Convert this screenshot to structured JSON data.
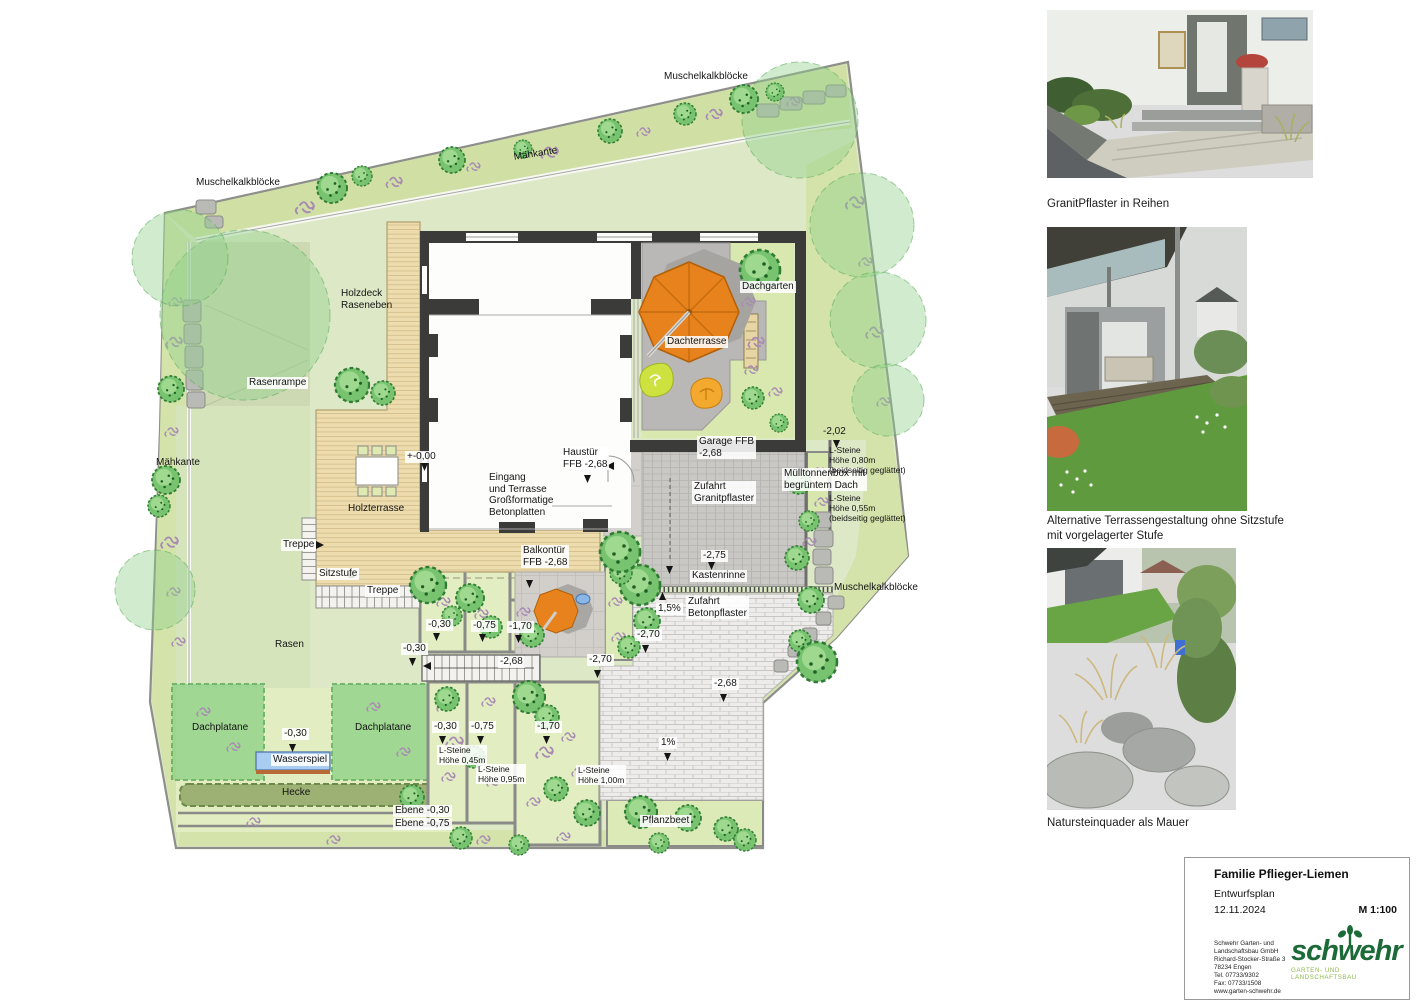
{
  "plan": {
    "labels": [
      {
        "t": "Muschelkalkblöcke"
      },
      {
        "t": "Mähkante"
      },
      {
        "t": "Muschelkalkblöcke"
      },
      {
        "t": "Holzdeck\nRaseneben"
      },
      {
        "t": "Rasenrampe"
      },
      {
        "t": "Mähkante"
      },
      {
        "t": "+-0,00"
      },
      {
        "t": "Holzterrasse"
      },
      {
        "t": "Haustür\nFFB  -2,68"
      },
      {
        "t": "Eingang\nund Terrasse\nGroßformatige\nBetonplatten"
      },
      {
        "t": "Garage FFB\n-2,68"
      },
      {
        "t": "Dachterrasse"
      },
      {
        "t": "Dachgarten"
      },
      {
        "t": "Zufahrt\nGranitpflaster"
      },
      {
        "t": "Mülltonnenbox mit\nbegrüntem Dach"
      },
      {
        "t": "-2,02"
      },
      {
        "t": "L-Steine\nHöhe 0,80m\n(beidseitig geglättet)"
      },
      {
        "t": "L-Steine\nHöhe 0,55m\n(beidseitig geglättet)"
      },
      {
        "t": "Muschelkalkblöcke"
      },
      {
        "t": "Treppe"
      },
      {
        "t": "Sitzstufe"
      },
      {
        "t": "Treppe"
      },
      {
        "t": "Balkontür\nFFB -2,68"
      },
      {
        "t": "-2,75"
      },
      {
        "t": "Kastenrinne"
      },
      {
        "t": "1,5%"
      },
      {
        "t": "Zufahrt\nBetonpflaster"
      },
      {
        "t": "-2,70"
      },
      {
        "t": "-2,70"
      },
      {
        "t": "-2,68"
      },
      {
        "t": "-2,68"
      },
      {
        "t": "1%"
      },
      {
        "t": "-0,30"
      },
      {
        "t": "-0,75"
      },
      {
        "t": "-1,70"
      },
      {
        "t": "-0,30"
      },
      {
        "t": "-0,30"
      },
      {
        "t": "Wasserspiel"
      },
      {
        "t": "Dachplatane"
      },
      {
        "t": "Dachplatane"
      },
      {
        "t": "-0,30"
      },
      {
        "t": "-0,75"
      },
      {
        "t": "-1,70"
      },
      {
        "t": "L-Steine\nHöhe 0,45m"
      },
      {
        "t": "L-Steine\nHöhe 0,95m"
      },
      {
        "t": "L-Steine\nHöhe 1,00m"
      },
      {
        "t": "Hecke"
      },
      {
        "t": "Ebene -0,30"
      },
      {
        "t": "Ebene -0,75"
      },
      {
        "t": "Pflanzbeet"
      },
      {
        "t": "Rasen"
      }
    ]
  },
  "sidebar": {
    "captions": [
      {
        "text": "GranitPflaster in Reihen"
      },
      {
        "text": "Alternative Terrassengestaltung ohne Sitzstufe\nmit vorgelagerter Stufe"
      },
      {
        "text": "Natursteinquader als Mauer"
      }
    ]
  },
  "titleblock": {
    "client": "Familie Pflieger-Liemen",
    "plan_type": "Entwurfsplan",
    "date": "12.11.2024",
    "scale": "M 1:100",
    "company_lines": [
      "Schwehr Garten- und",
      "Landschaftsbau GmbH",
      "Richard-Stocker-Straße 3",
      "78234 Engen",
      "Tel. 07733/9302",
      "Fax: 07733/1508",
      "www.garten-schwehr.de"
    ],
    "logo_text": "schwehr",
    "logo_tagline": "GARTEN- UND LANDSCHAFTSBAU"
  },
  "colors": {
    "umbrella_orange": "#e8821c",
    "lawn_green": "#dce8c6",
    "bed_green": "#e2edc1",
    "strip_green": "#d0e0a4",
    "wood_beige": "#ecdcae",
    "wall_dark": "#3b3b39",
    "logo_green": "#1b6a38",
    "tagline_green": "#8db94b"
  }
}
